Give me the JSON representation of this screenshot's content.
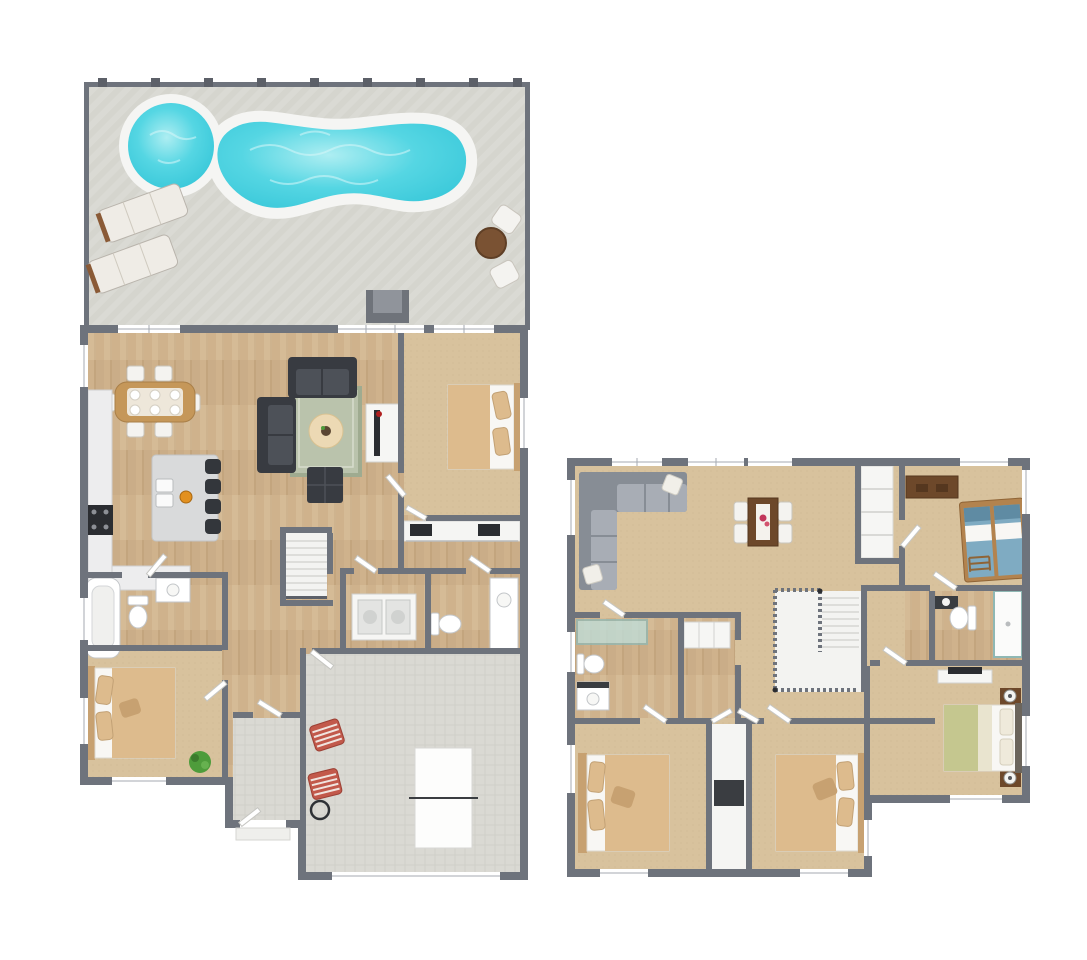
{
  "palette": {
    "background": "#ffffff",
    "wall": "#6e737c",
    "wall_dark": "#5c6068",
    "trim_white": "#ffffff",
    "door_stroke": "#c6c6c2",
    "wood": "#cfb28c",
    "wood_dark": "#c2a47e",
    "wood_light": "#dfc9a5",
    "plank_line": "#b3946c",
    "carpet": "#d8c29d",
    "carpet_dark": "#c9b28c",
    "tile": "#dad9d3",
    "tile_dark": "#c8c7c0",
    "deck": "#dadad4",
    "deck_dark": "#cfcfc8",
    "water": "#2fc3d6",
    "water_mid": "#55d6e3",
    "water_light": "#aeeef2",
    "rim_white": "#f5f5f3",
    "sofa_dark": "#383b41",
    "sofa_seat": "#4d5158",
    "sofa_gray": "#878d95",
    "sofa_gray_light": "#a8adb5",
    "rug": "#bac3ac",
    "rug_border": "#9fab90",
    "ottoman": "#ecd9b4",
    "wood_table": "#c59759",
    "wood_table_dark": "#7c5333",
    "chair_white": "#f4f3f0",
    "island": "#d9dadb",
    "counter": "#ededee",
    "black": "#2b2d31",
    "bed_tan": "#ddbb8d",
    "bed_tan_dark": "#c7a171",
    "sheet": "#f8f7f4",
    "sage": "#c5c78f",
    "cream": "#e9e4cf",
    "bunk_blue": "#7fabc2",
    "frame_wood": "#b3834e",
    "desk_brown": "#6d482a",
    "red_chair": "#c2594b",
    "plant": "#4e9c3b",
    "glass": "#bfe0dd",
    "orange": "#e2901f",
    "gray_chair": "#90949b",
    "gray_chair_dark": "#6f737a"
  },
  "scene": {
    "type": "3D top-down floor plan rendering, two floors side by side",
    "floors": [
      {
        "id": "first-floor",
        "areas": [
          "pool-patio",
          "dining-area",
          "kitchen",
          "living-room",
          "front-bedroom",
          "closet",
          "main-bathroom",
          "laundry",
          "powder-room",
          "stairs",
          "hallway",
          "rear-bedroom",
          "entry",
          "garage"
        ],
        "furniture": [
          "spa",
          "freeform-pool",
          "lounge-chair",
          "lounge-chair",
          "patio-table",
          "patio-chair",
          "patio-chair",
          "outdoor-armchair",
          "dining-table",
          "dining-chairs-x6",
          "kitchen-island",
          "bar-stools-x4",
          "range",
          "counter-sink-run",
          "sofa",
          "loveseat",
          "area-rug",
          "round-ottoman",
          "tv-console",
          "tv",
          "square-ottoman",
          "bed",
          "closet-shelving",
          "bathtub",
          "toilet",
          "vanity",
          "washer-dryer",
          "powder-toilet",
          "powder-vanity",
          "bed",
          "potted-plant",
          "ping-pong-table",
          "folding-chair",
          "folding-chair",
          "round-side-table"
        ]
      },
      {
        "id": "second-floor",
        "areas": [
          "family-room",
          "game-nook",
          "bunk-bedroom",
          "hall-bathroom",
          "walk-in-closet-a",
          "walk-in-closet-b",
          "left-bathroom",
          "stairwell",
          "hallway",
          "master-bedroom",
          "left-bedroom",
          "middle-bedroom",
          "linen-closet"
        ],
        "furniture": [
          "sectional-sofa",
          "throw-pillow",
          "throw-pillow",
          "game-table",
          "game-chairs-x4",
          "desk",
          "twin-beds-x2",
          "bed-ladder",
          "hall-toilet",
          "hall-shower",
          "hall-vanity",
          "left-shower",
          "left-toilet",
          "left-vanity",
          "wardrobe",
          "linen-shelves",
          "dresser",
          "tv",
          "nightstand",
          "nightstand",
          "lamp",
          "lamp",
          "master-bed",
          "bed",
          "bed",
          "closet-cabinet"
        ]
      }
    ]
  }
}
